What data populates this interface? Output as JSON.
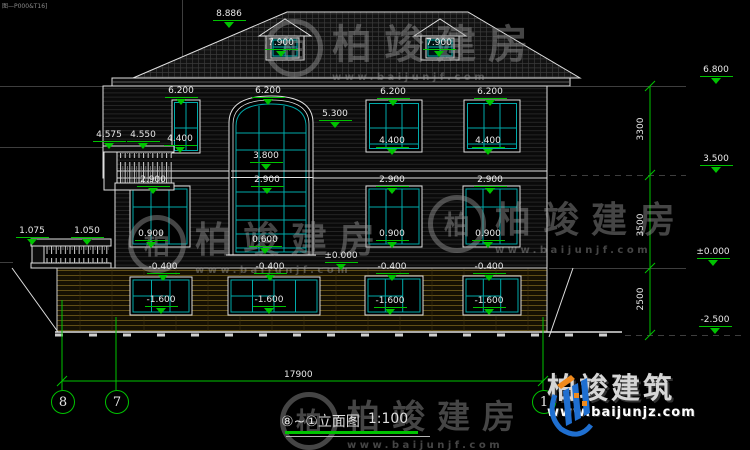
{
  "corner_note": "图—P000&T16]",
  "levels": {
    "ridge": "8.886",
    "dormer": "7.900",
    "eave": "6.800",
    "f3_window_head": "6.200",
    "arch_spring": "5.300",
    "balcony_rail_outer": "4.575",
    "balcony_rail_inner": "4.550",
    "f3_window_sill": "4.400",
    "arch_transom": "3.800",
    "f3_floor": "3.500",
    "f2_window_head": "2.900",
    "terrace_rail_outer": "1.075",
    "terrace_rail_inner": "1.050",
    "f2_window_sill": "0.900",
    "arch_sill": "0.600",
    "ground": "±0.000",
    "basement_window_head": "-0.400",
    "basement_window_sill": "-1.600",
    "footing": "-2.500"
  },
  "dimensions": {
    "upper_floor_height": "3300",
    "main_floor_height": "3500",
    "basement_height": "2500",
    "total_width": "17900"
  },
  "grid_bubbles": {
    "left": "8",
    "middle": "7",
    "right": "1"
  },
  "title": {
    "name": "⑧~①立面图",
    "scale": "1:100"
  },
  "watermark": {
    "monogram": "柏",
    "brand": "柏竣建房",
    "url": "www.baijunjf.com"
  },
  "footer_logo": {
    "brand": "柏竣建筑",
    "url": "www.baijunjz.com"
  },
  "colors": {
    "dimension_green": "#00c300",
    "glass_teal": "#00aaaa",
    "line_white": "#e0e0e0",
    "basement_tan": "#6b5718",
    "logo_blue": "#1f6fd0",
    "logo_orange": "#f08a1d"
  }
}
